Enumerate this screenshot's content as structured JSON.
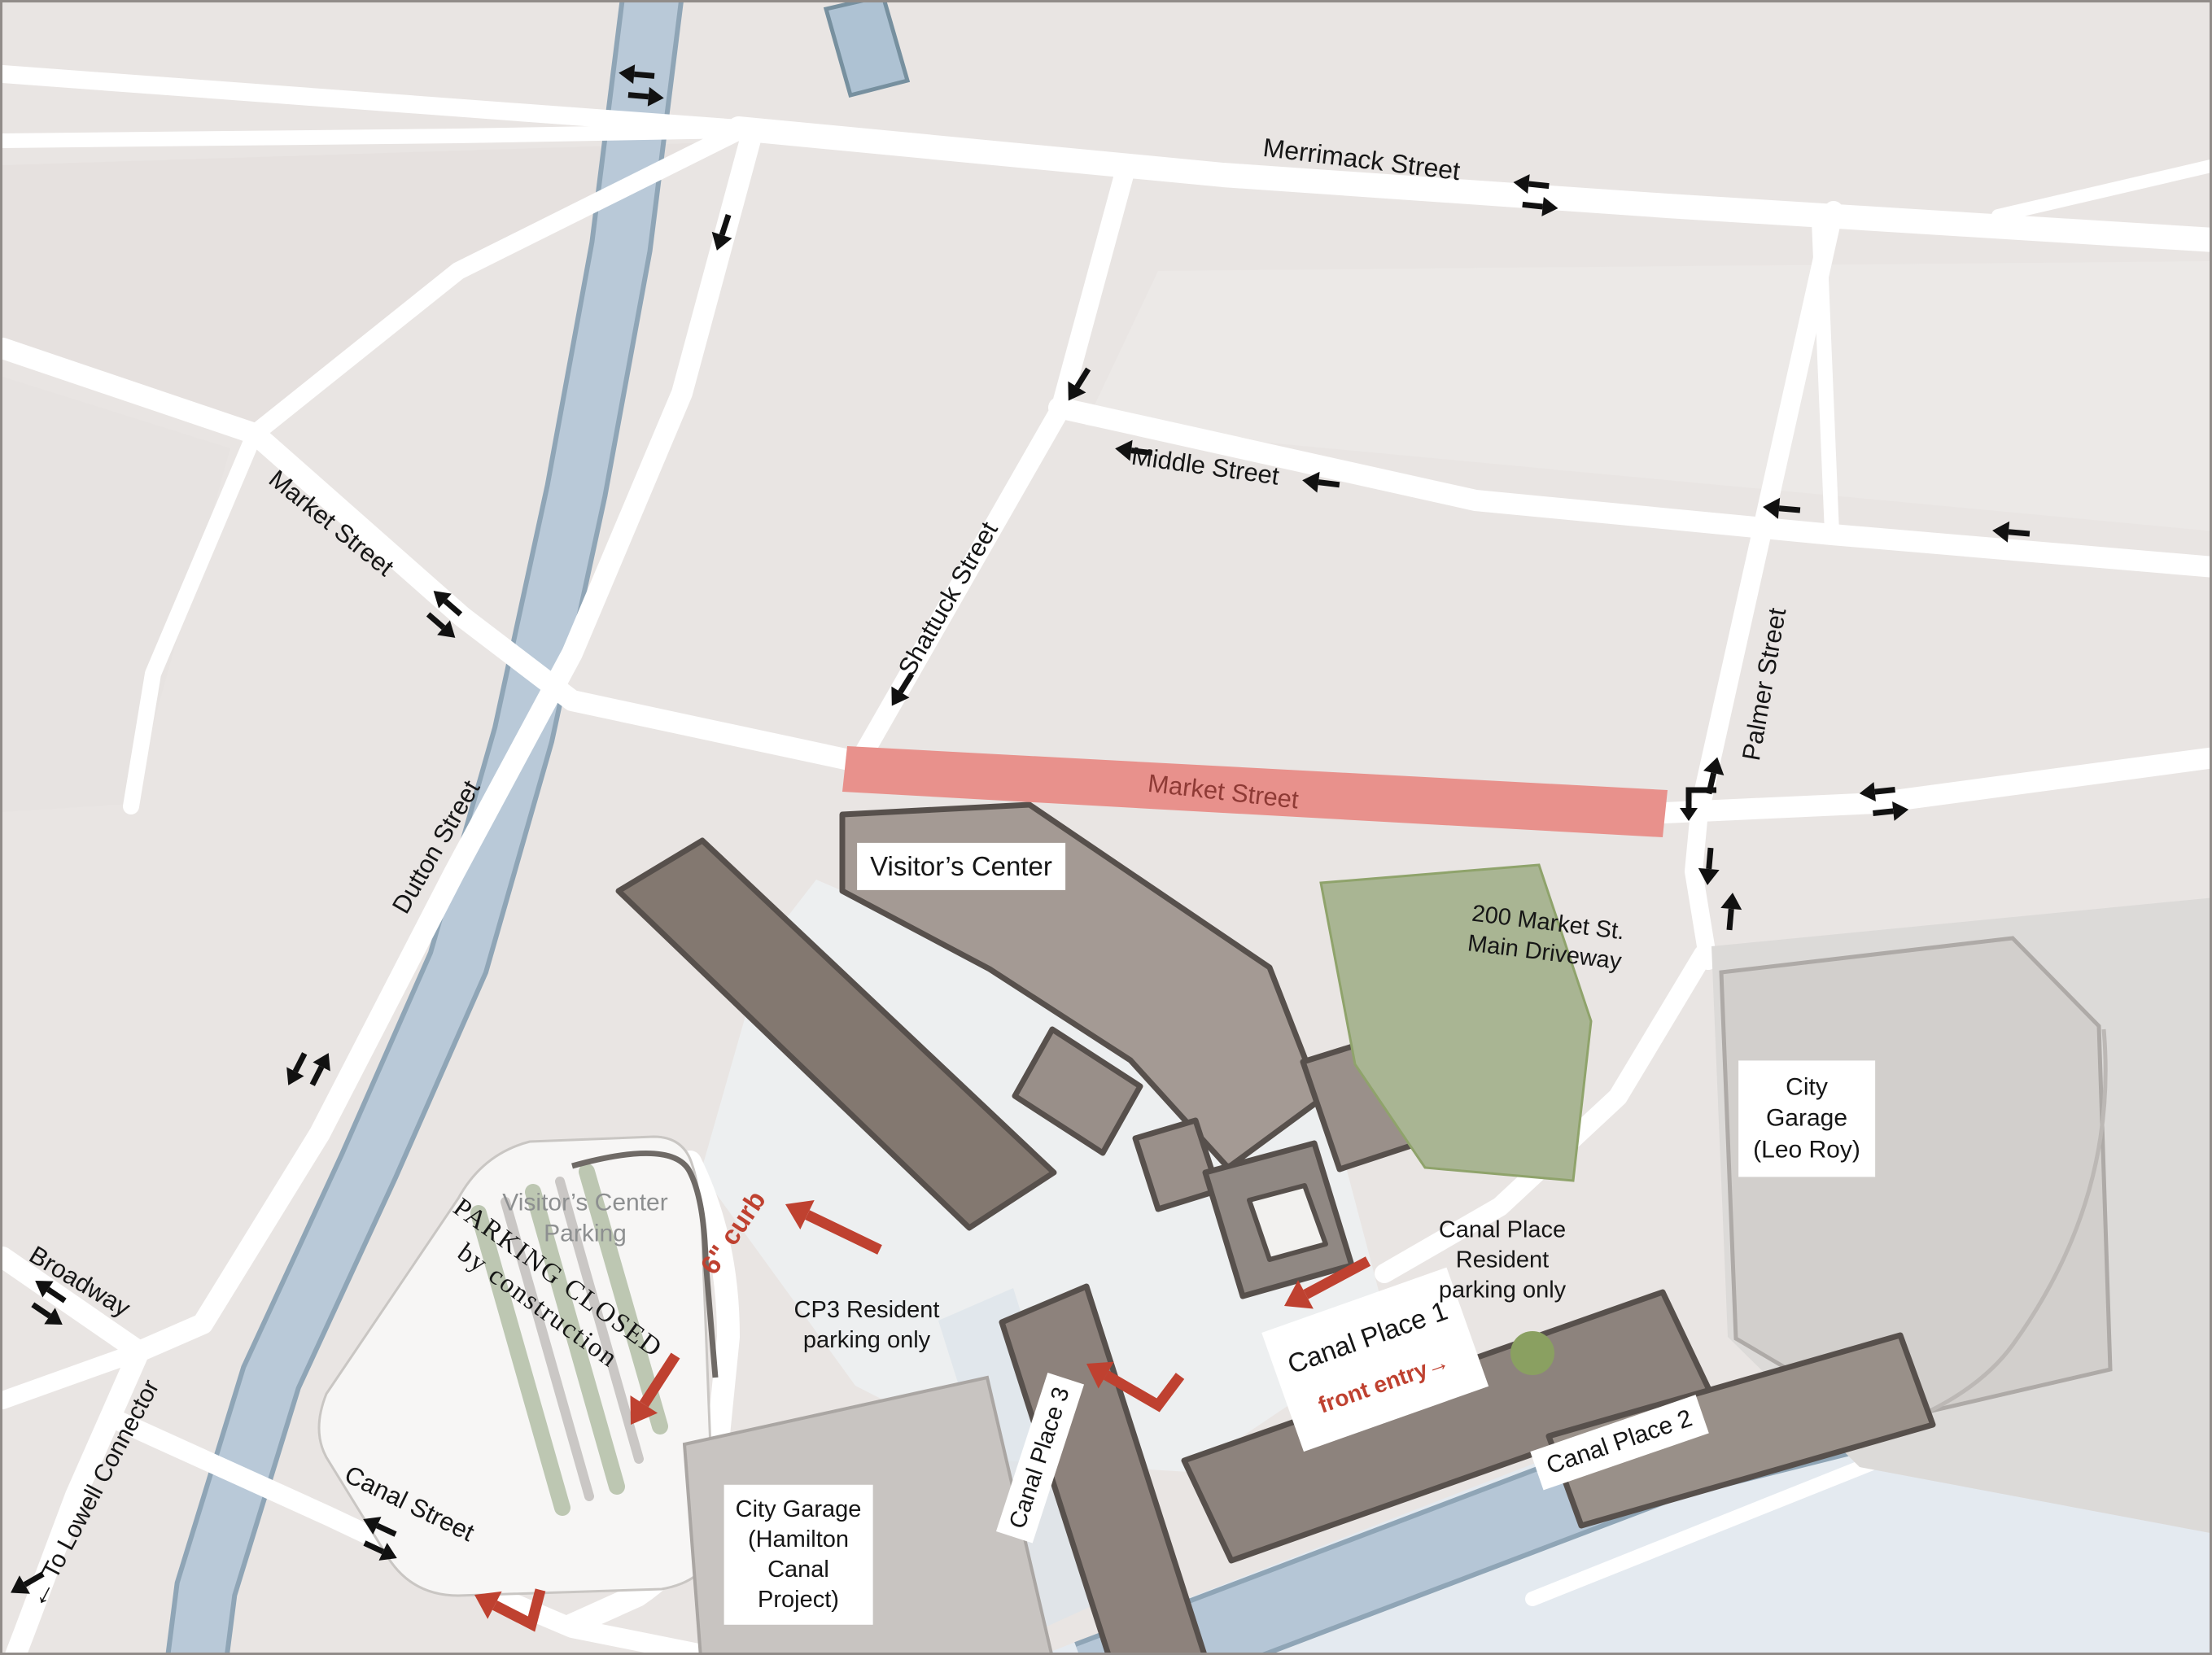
{
  "streets": {
    "merrimack": "Merrimack Street",
    "middle": "Middle Street",
    "market": "Market Street",
    "market_closed": "Market Street",
    "shattuck": "Shattuck Street",
    "palmer": "Palmer Street",
    "dutton": "Dutton Street",
    "broadway": "Broadway",
    "canal": "Canal Street",
    "lowell_connector": "To Lowell Connector"
  },
  "places": {
    "visitors_center": "Visitor’s Center",
    "city_garage_leo_roy": "City\nGarage\n(Leo Roy)",
    "city_garage_hamilton": "City Garage\n(Hamilton\nCanal\nProject)",
    "canal_place_1": "Canal Place 1",
    "canal_place_2": "Canal Place 2",
    "canal_place_3": "Canal Place 3"
  },
  "annotations": {
    "main_driveway": "200 Market St.\nMain Driveway",
    "visitors_center_parking": "Visitor’s Center\nParking",
    "parking_closed": "PARKING CLOSED\nby construction",
    "curb": "6\" curb",
    "cp3_parking": "CP3 Resident\nparking only",
    "canal_place_parking": "Canal Place\nResident\nparking only",
    "front_entry": "front entry"
  },
  "icons": {
    "left_arrow": "←",
    "right_arrow": "→"
  },
  "colors": {
    "background": "#e9e5e3",
    "street": "#ffffff",
    "water": "#b9c9d8",
    "water_edge": "#8fa5b6",
    "closed_road": "#e8918c",
    "closed_road_text": "#8e3a35",
    "annotation_red": "#bf4130",
    "building": "#a49a94",
    "building_dark": "#837870",
    "green_space": "#a9b593",
    "muted_label": "#8d8f90"
  }
}
